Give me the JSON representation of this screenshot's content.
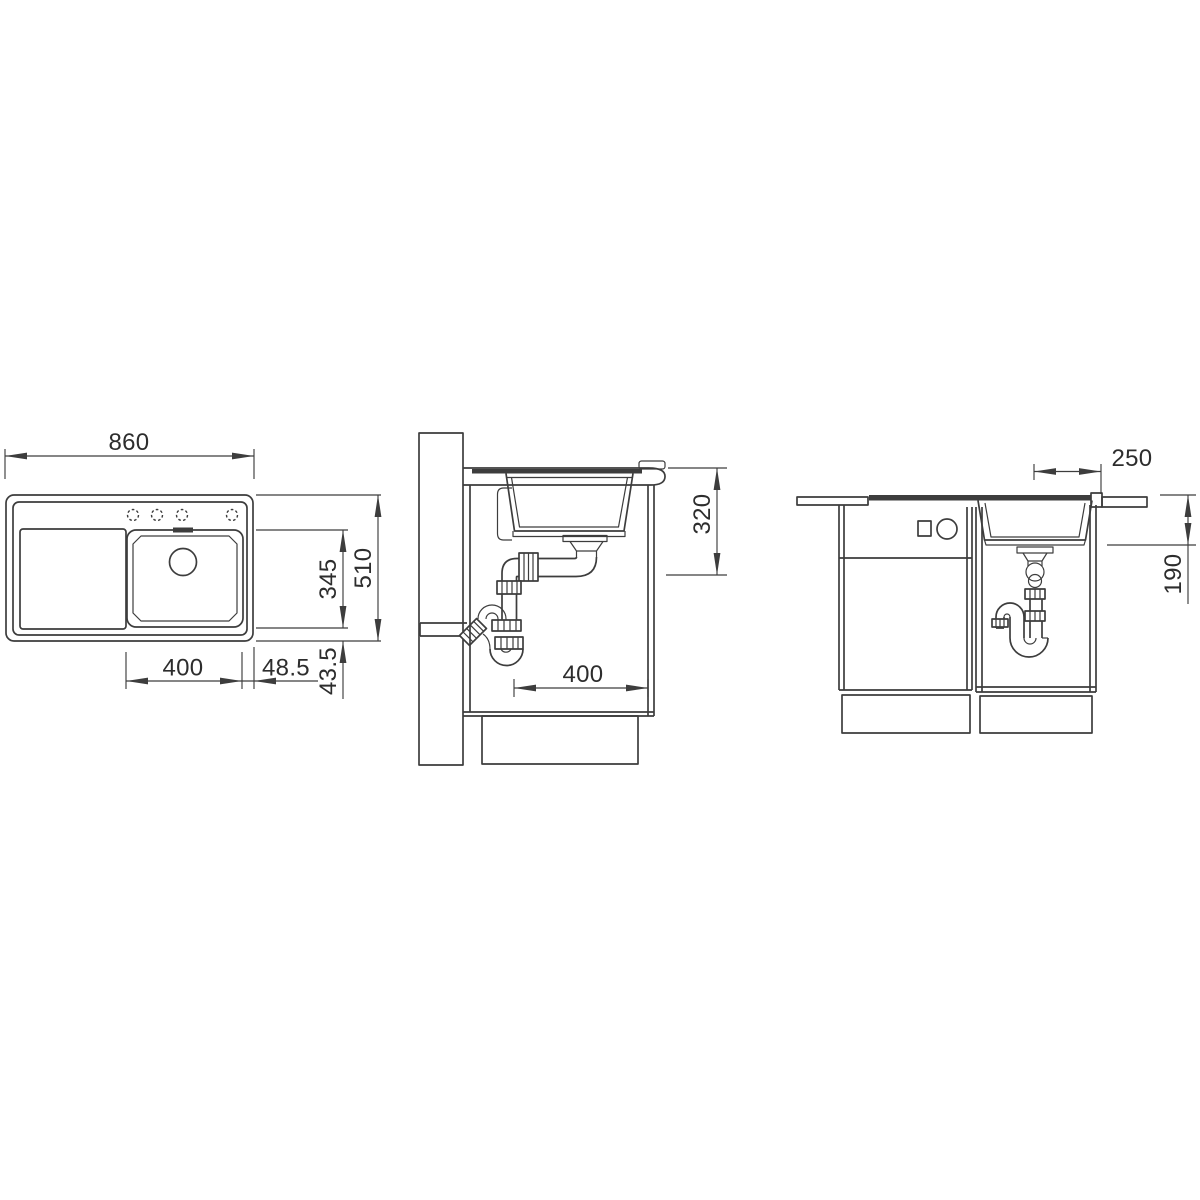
{
  "colors": {
    "ink": "#3d3d3d",
    "paper": "#ffffff"
  },
  "views": {
    "top": {
      "dims": {
        "overall_width": "860",
        "bowl_width": "400",
        "offset_right": "48.5",
        "offset_bottom": "43.5",
        "bowl_length": "345",
        "overall_depth": "510"
      }
    },
    "section": {
      "dims": {
        "depth_below_worktop": "320",
        "drain_offset": "400"
      }
    },
    "front": {
      "dims": {
        "drain_axis_offset": "250",
        "underbench_depth": "190"
      }
    }
  }
}
